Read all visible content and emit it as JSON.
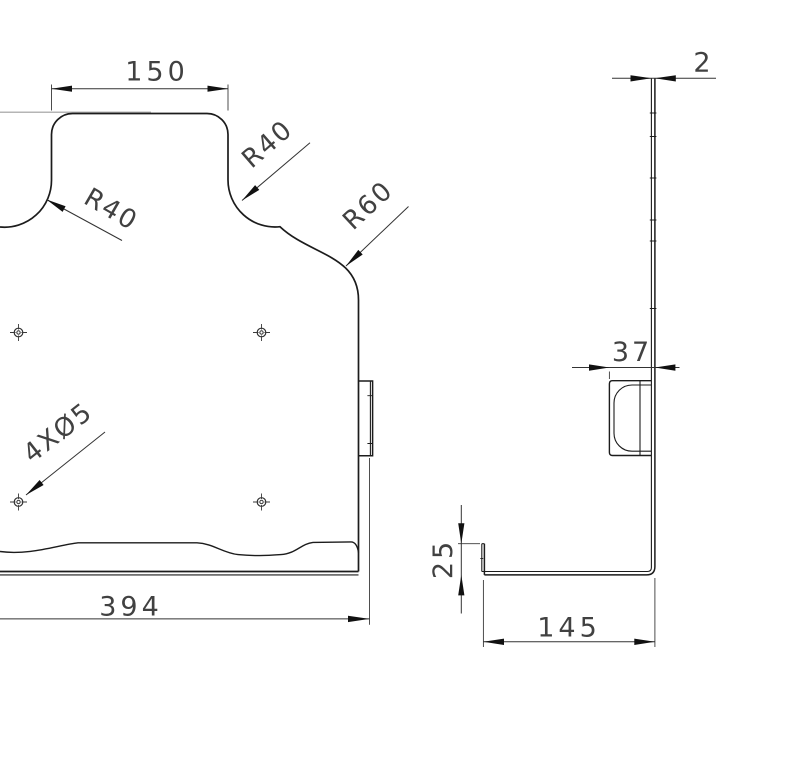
{
  "drawing": {
    "background_color": "#ffffff",
    "object_line_color": "#1c1c1c",
    "dimension_line_color": "#333333",
    "text_color": "#414141",
    "aux_line_color": "#b5b5b5",
    "front_view": {
      "hole_count": 4,
      "dims": {
        "top_width": "150",
        "left_radius": "R40",
        "right_radius": "R40",
        "lower_right_radius": "R60",
        "hole_callout": "4XØ5",
        "overall_width": "394"
      }
    },
    "side_view": {
      "dims": {
        "thickness": "2",
        "tab_width": "37",
        "lip_height": "25",
        "base_length": "145"
      }
    }
  }
}
